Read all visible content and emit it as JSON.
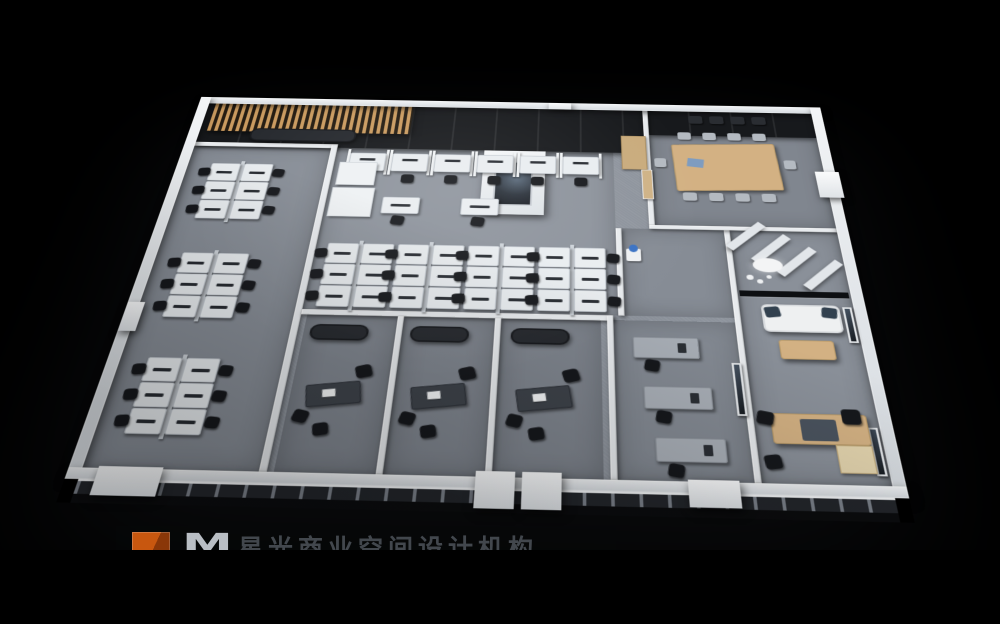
{
  "image_type": "3d-isometric-office-floorplan-render",
  "palette": {
    "background": "#000000",
    "wall_top": "#e8ebee",
    "wall_side": "#c7ccd2",
    "carpet": "#8d939c",
    "carpet_dark": "#7f858e",
    "dark_wall": "#17191c",
    "wood_slat": "#c99a5f",
    "wood_light": "#d3b183",
    "wood_door": "#cfb286",
    "desk_white": "#e9edf0",
    "desk_dark": "#3e434a",
    "chair_black": "#16181c",
    "sofa_dark": "#26292e",
    "sofa_white": "#eef0f1",
    "pillow_navy": "#32414f",
    "glass_dark": "#0d0f12",
    "logo_orange": "#c8570f"
  },
  "watermark": {
    "letter": "M",
    "text": "星光商业空间设计机构",
    "clipped_by_letterbox": true,
    "logo_color": "#c8570f"
  },
  "scene": {
    "view": "axonometric top-down office interior render on black background",
    "rooms": [
      {
        "name": "reception",
        "features": [
          "wood-slat-canopy",
          "dark-feature-wall",
          "dark-bench"
        ]
      },
      {
        "name": "open-office-left-wing",
        "workstation_clusters": 3,
        "desks": 18
      },
      {
        "name": "open-office-center",
        "workstation_clusters": 4,
        "desks": 24,
        "carrel_desks": 6,
        "single_desks": 2,
        "features": [
          "feature-column-with-art",
          "printer-cabinets",
          "dark-glass-north-wall"
        ]
      },
      {
        "name": "conference-room",
        "chairs": 10,
        "wall_chairs": 4,
        "features": [
          "wood-table",
          "dark-feature-wall"
        ]
      },
      {
        "name": "corridor",
        "features": [
          "wood-door",
          "water-cooler",
          "wood-cabinet"
        ]
      },
      {
        "name": "manager-office-1",
        "furniture": [
          "dark-desk",
          "task-chair",
          "guest-chair",
          "guest-chair",
          "dark-sofa"
        ]
      },
      {
        "name": "manager-office-2",
        "furniture": [
          "dark-desk",
          "task-chair",
          "guest-chair",
          "guest-chair",
          "dark-sofa"
        ]
      },
      {
        "name": "manager-office-3",
        "furniture": [
          "dark-desk",
          "task-chair",
          "guest-chair",
          "guest-chair",
          "dark-sofa"
        ]
      },
      {
        "name": "admin-office",
        "desks": 3,
        "features": [
          "wall-art"
        ]
      },
      {
        "name": "executive-lounge",
        "furniture": [
          "white-sofa",
          "navy-pillows",
          "coffee-table",
          "pendant-lamp",
          "glass-partition",
          "wall-art",
          "zigzag-partitions"
        ]
      },
      {
        "name": "executive-office",
        "furniture": [
          "l-shaped-wood-desk",
          "executive-chair",
          "guest-chair",
          "guest-chair",
          "wall-art"
        ]
      }
    ],
    "left_clusters": [
      {
        "x": 38,
        "y": 118
      },
      {
        "x": 38,
        "y": 258
      },
      {
        "x": 38,
        "y": 398
      }
    ],
    "center_clusters": [
      {
        "x": 184,
        "y": 240
      },
      {
        "x": 256,
        "y": 240
      },
      {
        "x": 328,
        "y": 240
      },
      {
        "x": 400,
        "y": 240
      }
    ],
    "cluster_spec": {
      "cols": 2,
      "rows": 3,
      "desk_w": 32,
      "desk_h": 29
    },
    "carrels": {
      "count": 6,
      "x0": 188,
      "dx": 47,
      "y": 96,
      "w": 40,
      "h": 30
    },
    "single_desks": [
      {
        "x": 232,
        "y": 168
      },
      {
        "x": 316,
        "y": 168
      }
    ],
    "conference": {
      "table": {
        "x": 545,
        "y": 70,
        "w": 115,
        "h": 78
      },
      "chair_xs": [
        552,
        580,
        608,
        636
      ],
      "chairs_top_y": 50,
      "chairs_bottom_y": 152,
      "end_chairs": [
        {
          "x": 666,
          "y": 96
        },
        {
          "x": 524,
          "y": 96
        }
      ],
      "wall_chair_xs": [
        566,
        590,
        614,
        638
      ],
      "wall_chairs_y": 20
    },
    "manager_offices": [
      {
        "ox": 180
      },
      {
        "ox": 276
      },
      {
        "ox": 372
      }
    ],
    "admin_desks": [
      {
        "x": 492,
        "y": 360
      },
      {
        "x": 500,
        "y": 420
      },
      {
        "x": 508,
        "y": 478
      }
    ],
    "sprites": [
      {
        "t": "sofa-dark",
        "n": "reception-bench",
        "x": 70,
        "y": 56,
        "w": 120,
        "h": 22
      },
      {
        "t": "cab-white",
        "n": "printer-cabinet",
        "x": 178,
        "y": 112,
        "w": 42,
        "h": 38
      },
      {
        "t": "cab-white",
        "n": "copier",
        "x": 176,
        "y": 154,
        "w": 46,
        "h": 46
      },
      {
        "t": "doc",
        "n": "table-document",
        "x": 560,
        "y": 96,
        "w": 18,
        "h": 14,
        "r": 8
      },
      {
        "t": "wood-cab",
        "n": "storage-cabinet",
        "x": 488,
        "y": 58,
        "w": 28,
        "h": 58
      },
      {
        "t": "door-wood",
        "n": "wood-door",
        "x": 509,
        "y": 116,
        "w": 12,
        "h": 48
      },
      {
        "t": "cooler",
        "n": "water-cooler",
        "x": 489,
        "y": 240,
        "w": 15,
        "h": 18
      },
      {
        "t": "partition",
        "n": "zigzag-partition",
        "x": 608,
        "y": 192,
        "w": 10,
        "h": 52,
        "r": 45
      },
      {
        "t": "partition",
        "n": "zigzag-partition",
        "x": 632,
        "y": 210,
        "w": 10,
        "h": 52,
        "r": 45
      },
      {
        "t": "partition",
        "n": "zigzag-partition",
        "x": 656,
        "y": 228,
        "w": 10,
        "h": 52,
        "r": 45
      },
      {
        "t": "partition",
        "n": "zigzag-partition",
        "x": 680,
        "y": 246,
        "w": 10,
        "h": 52,
        "r": 45
      },
      {
        "t": "lamp",
        "n": "pendant-lamp",
        "x": 616,
        "y": 250,
        "w": 30,
        "h": 20
      },
      {
        "t": "dot",
        "n": "pendant-bulb",
        "x": 608,
        "y": 274,
        "w": 7,
        "h": 7
      },
      {
        "t": "dot",
        "n": "pendant-bulb",
        "x": 618,
        "y": 280,
        "w": 6,
        "h": 6
      },
      {
        "t": "dot",
        "n": "pendant-bulb",
        "x": 628,
        "y": 274,
        "w": 5,
        "h": 5
      },
      {
        "t": "glass",
        "n": "glass-partition",
        "x": 599,
        "y": 296,
        "w": 107,
        "h": 8
      },
      {
        "t": "sofa-white",
        "n": "lounge-sofa",
        "x": 618,
        "y": 314,
        "w": 76,
        "h": 36
      },
      {
        "t": "pillow",
        "n": "sofa-pillow",
        "x": 621,
        "y": 317,
        "w": 15,
        "h": 14,
        "r": -8
      },
      {
        "t": "pillow",
        "n": "sofa-pillow",
        "x": 676,
        "y": 317,
        "w": 15,
        "h": 14,
        "r": 8
      },
      {
        "t": "table-wood",
        "n": "coffee-table",
        "x": 630,
        "y": 360,
        "w": 52,
        "h": 24
      },
      {
        "t": "art",
        "n": "wall-art",
        "x": 697,
        "y": 316,
        "w": 9,
        "h": 46
      },
      {
        "t": "art",
        "n": "wall-art",
        "x": 697,
        "y": 462,
        "w": 9,
        "h": 52
      },
      {
        "t": "art",
        "n": "wall-art",
        "x": 583,
        "y": 390,
        "w": 9,
        "h": 62
      },
      {
        "t": "table-wood",
        "n": "executive-desk",
        "x": 612,
        "y": 448,
        "w": 86,
        "h": 34
      },
      {
        "t": "inlay",
        "n": "desk-inlay",
        "x": 638,
        "y": 454,
        "w": 32,
        "h": 24
      },
      {
        "t": "wood-light",
        "n": "desk-return",
        "x": 666,
        "y": 482,
        "w": 32,
        "h": 30
      },
      {
        "t": "chair-black",
        "n": "executive-chair",
        "x": 676,
        "y": 442,
        "w": 17,
        "h": 17
      },
      {
        "t": "chair-black",
        "n": "guest-chair",
        "x": 600,
        "y": 446,
        "w": 15,
        "h": 15,
        "r": 12
      },
      {
        "t": "chair-black",
        "n": "guest-chair",
        "x": 602,
        "y": 494,
        "w": 15,
        "h": 15,
        "r": -8
      }
    ]
  }
}
